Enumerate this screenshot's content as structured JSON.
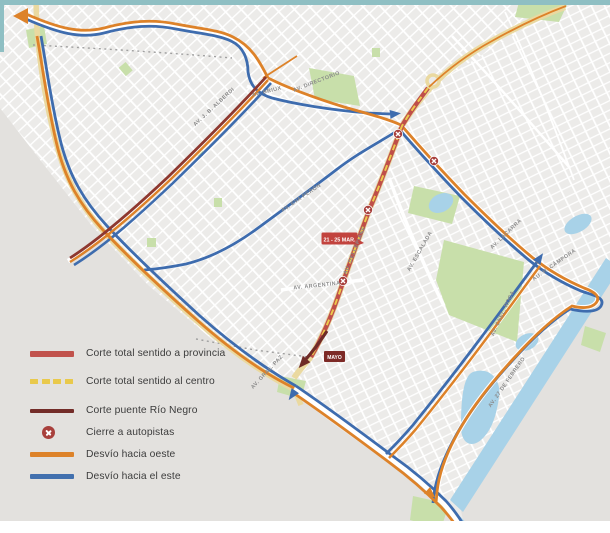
{
  "legend": {
    "items": [
      {
        "label": "Corte total sentido a provincia",
        "style": "solid-thick",
        "color": "#c1524c"
      },
      {
        "label": "Corte total sentido al centro",
        "style": "dashed",
        "color": "#e9c94b"
      },
      {
        "label": "Corte puente Río Negro",
        "style": "solid",
        "color": "#732c28"
      },
      {
        "label": "Cierre a autopistas",
        "style": "x-marker",
        "color": "#a8403c"
      },
      {
        "label": "Desvío hacia oeste",
        "style": "solid",
        "color": "#dd8229"
      },
      {
        "label": "Desvío hacia el este",
        "style": "solid",
        "color": "#4270ae"
      }
    ]
  },
  "badges": [
    {
      "text": "21 - 25 MAR.",
      "color": "#c2433e"
    },
    {
      "text": "MAYO",
      "color": "#7d2a26"
    }
  ],
  "map": {
    "labels": [
      "AV. J. B. ALBERDI",
      "AV. BRIUX",
      "AV. DIRECTORIO",
      "AV. EVA PERÓN",
      "AU. DELLEPIANE",
      "AV. ESCALADA",
      "AV. ARGENTINA",
      "AV. GRAL. PAZ",
      "AV. LACARRA",
      "AU. H. CÁMPORA",
      "AV. CNEL. ROCA",
      "AV. 27 DE FEBRERO"
    ],
    "colors": {
      "background": "#ecebe9",
      "outside": "#e3e1de",
      "street": "#ffffff",
      "park": "#c8dfaa",
      "water": "#a8d2e8",
      "highway": "#ead9a0",
      "border_teal": "#8fbfc3",
      "route_closure_red": "#bf4f49",
      "route_closure_yellow": "#ecc94b",
      "route_bridge_maroon": "#6f2b27",
      "route_detour_west_orange": "#dd8229",
      "route_detour_east_blue": "#3e6cae"
    }
  }
}
